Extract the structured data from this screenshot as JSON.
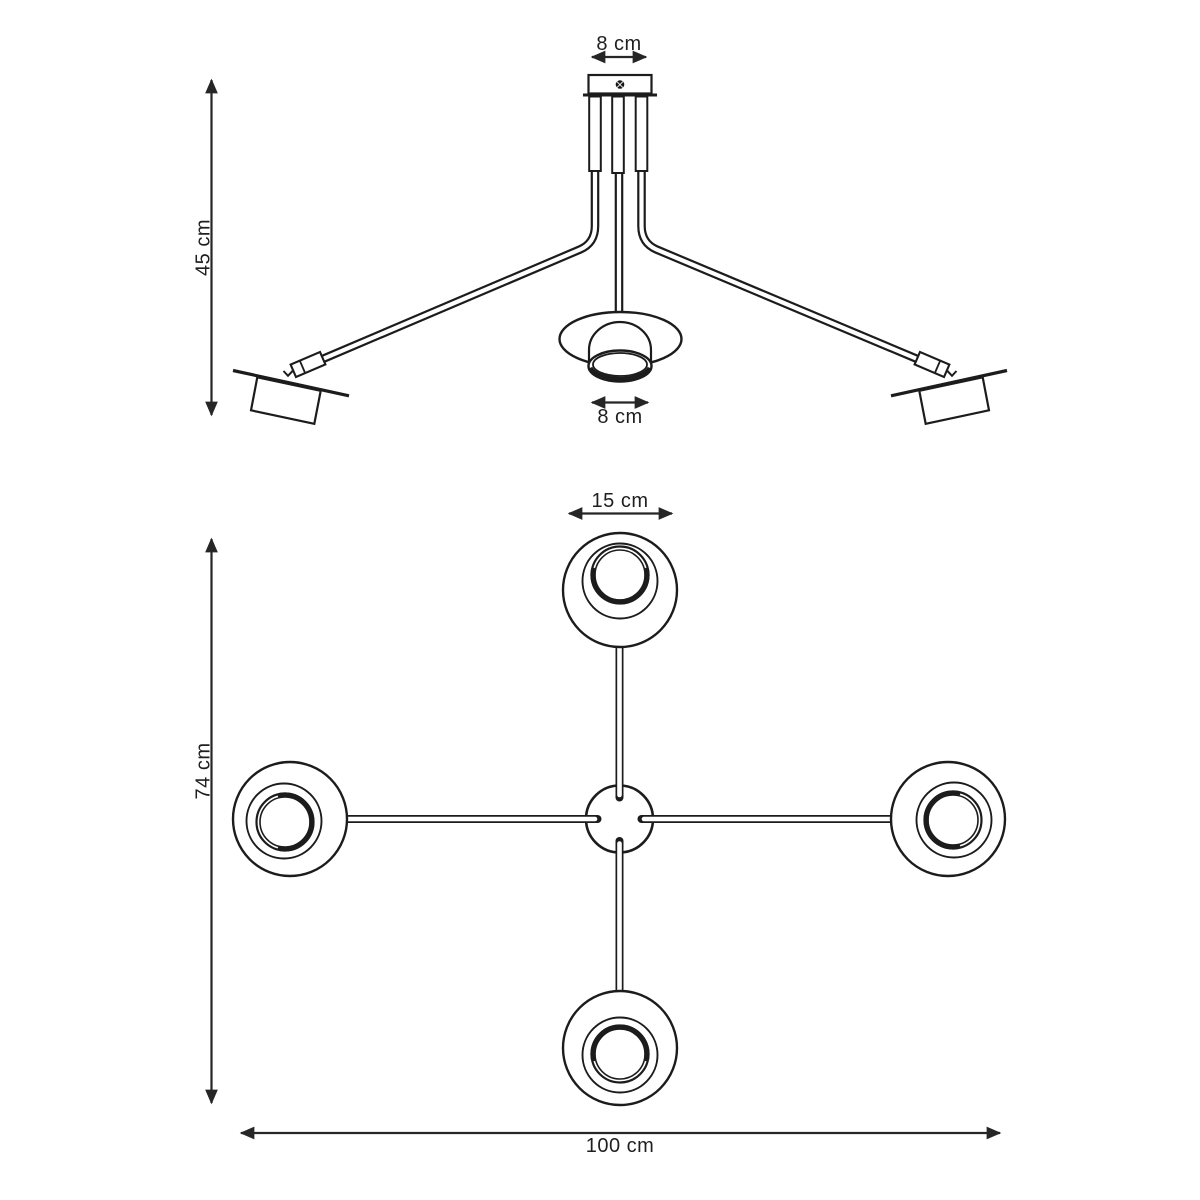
{
  "diagram": {
    "background_color": "#ffffff",
    "line_color": "#1c1c1c",
    "text_color": "#1f1f1f",
    "side_view": {
      "canopy_width_label": "8 cm",
      "overall_height_label": "45 cm",
      "center_shade_width_label": "8 cm"
    },
    "top_view": {
      "head_diameter_label": "15 cm",
      "overall_depth_label": "74 cm",
      "overall_width_label": "100 cm"
    }
  }
}
